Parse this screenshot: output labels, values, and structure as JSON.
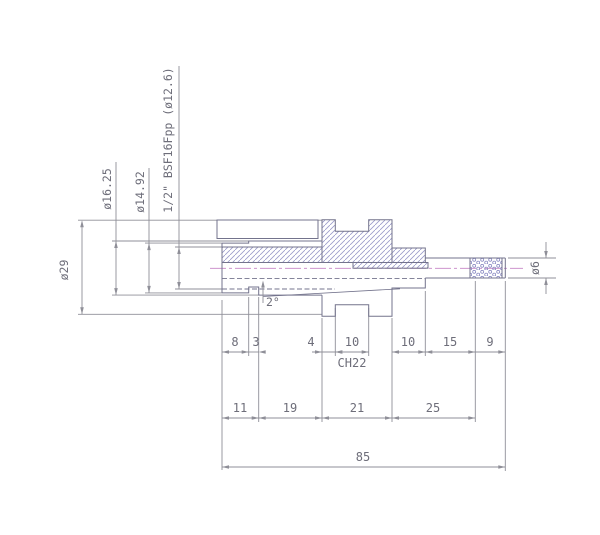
{
  "drawing": {
    "title": "shaft-section-drawing",
    "callouts": {
      "d29": "ø29",
      "d1625": "ø16.25",
      "d1492": "ø14.92",
      "thread": "1/2\" BSF16Fpp (ø12.6)",
      "d6": "ø6",
      "angle": "2°",
      "hex": "CH22"
    },
    "row1": [
      "8",
      "3",
      "4",
      "10",
      "10",
      "15",
      "9"
    ],
    "row2": [
      "11",
      "19",
      "21",
      "25"
    ],
    "total": "85",
    "colors": {
      "background": "#ffffff",
      "part_outline": "#73738c",
      "hatch": "#9a9ac9",
      "centerline": "#c583c5",
      "dimension": "#8f8f98",
      "text": "#6e6e7a"
    }
  }
}
